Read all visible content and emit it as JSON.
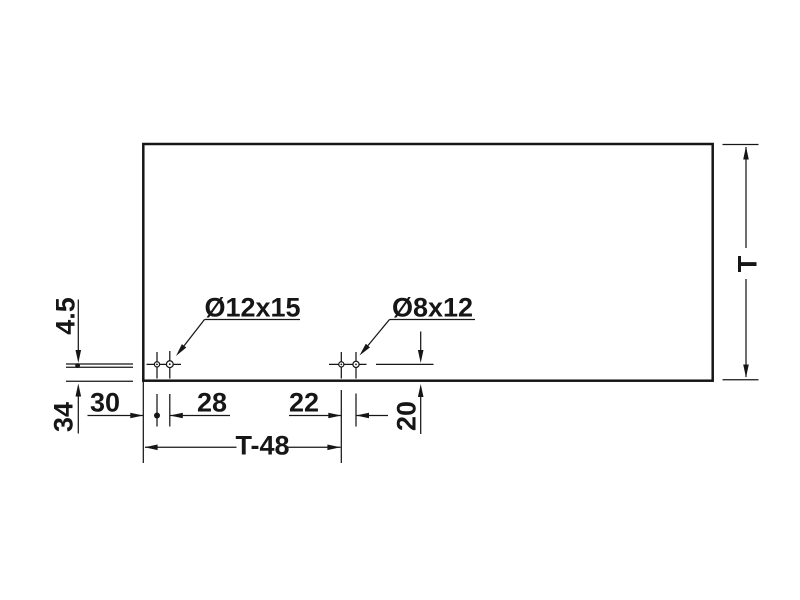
{
  "drawing": {
    "kind": "drilling-pattern-technical-drawing",
    "colors": {
      "line": "#161616",
      "background": "#ffffff"
    },
    "labels": {
      "hole_left": "Ø12x15",
      "hole_right": "Ø8x12",
      "edge_offset": "4.5",
      "bottom_edge_distance": "34",
      "front_edge_to_hole": "30",
      "left_pair_spacing": "28",
      "right_pair_spacing": "22",
      "hole_center_height": "20",
      "hole_span": "T-48",
      "panel_dimension": "T"
    }
  }
}
